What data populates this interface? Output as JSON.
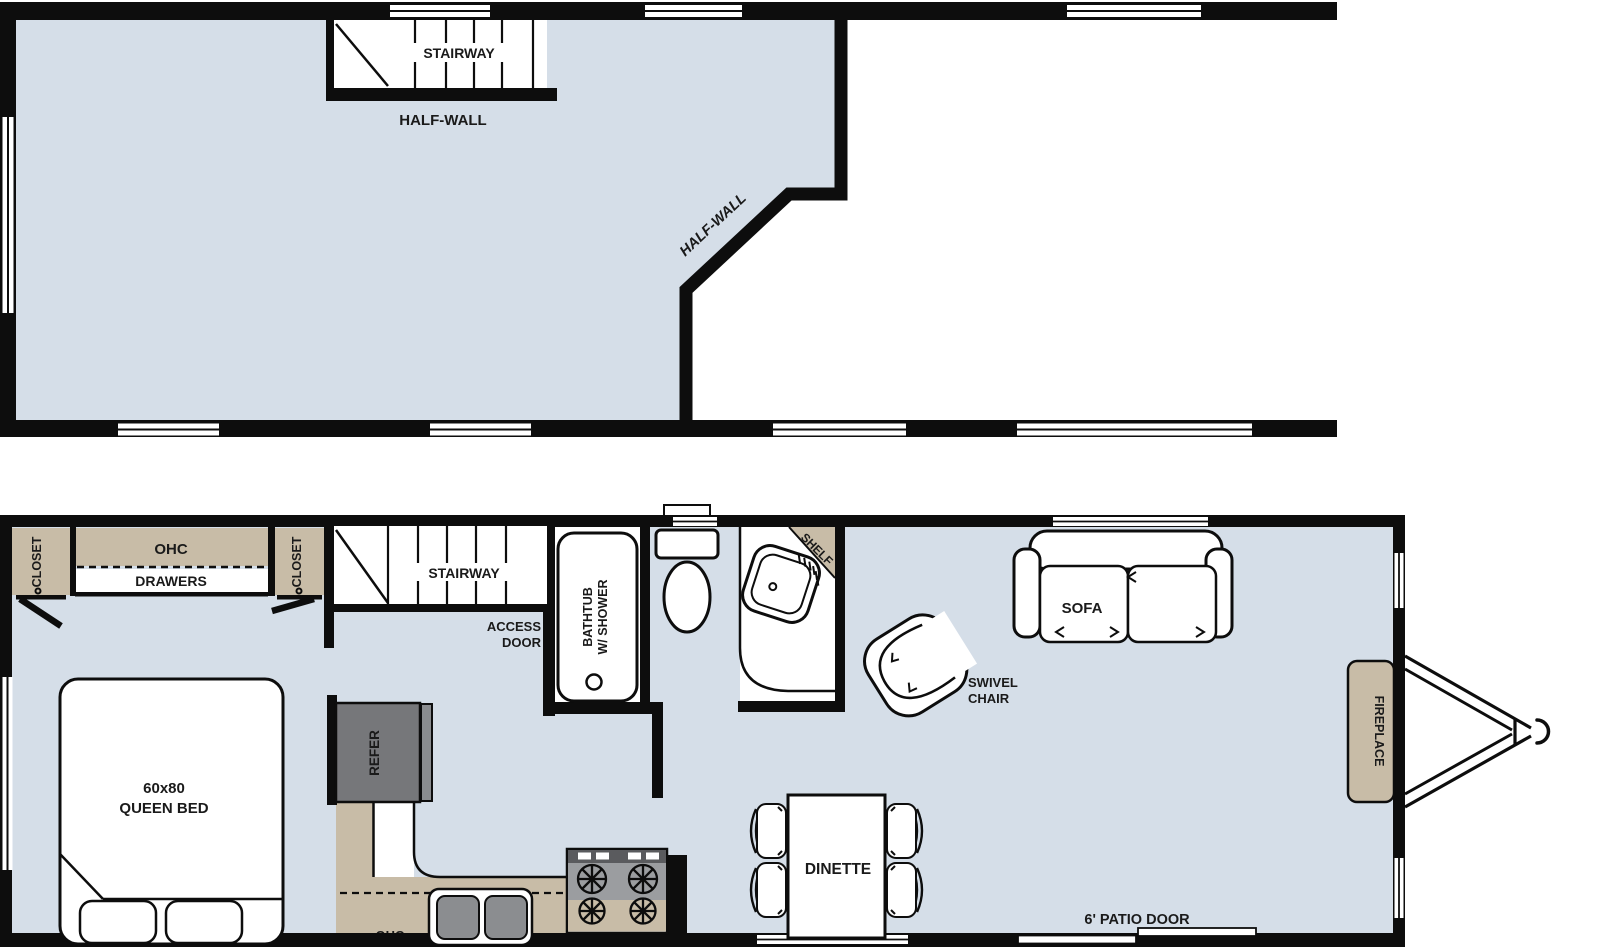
{
  "colors": {
    "floor": "#d5dee8",
    "cabinet": "#c8bca7",
    "wall": "#0d0d0d",
    "refer_body": "#76777a",
    "refer_door": "#8a8c8f",
    "cooktop_top": "#5a5b5e",
    "cooktop": "#9b9da0",
    "sink_bowl": "#8b8d90",
    "text": "#1a1a1a"
  },
  "upper": {
    "stairway": "STAIRWAY",
    "half_wall": "HALF-WALL",
    "half_wall_diagonal": "HALF-WALL"
  },
  "lower": {
    "closet_left": "CLOSET",
    "closet_right": "CLOSET",
    "ohc_bedroom": "OHC",
    "drawers": "DRAWERS",
    "queen_bed_size": "60x80",
    "queen_bed": "QUEEN BED",
    "stairway": "STAIRWAY",
    "access_door_1": "ACCESS",
    "access_door_2": "DOOR",
    "bathtub_1": "BATHTUB",
    "bathtub_2": "W/ SHOWER",
    "shelf": "SHELF",
    "refer": "REFER",
    "ohc_kitchen": "OHC",
    "dinette": "DINETTE",
    "sofa": "SOFA",
    "swivel_1": "SWIVEL",
    "swivel_2": "CHAIR",
    "fireplace": "FIREPLACE",
    "patio_door": "6' PATIO DOOR"
  }
}
